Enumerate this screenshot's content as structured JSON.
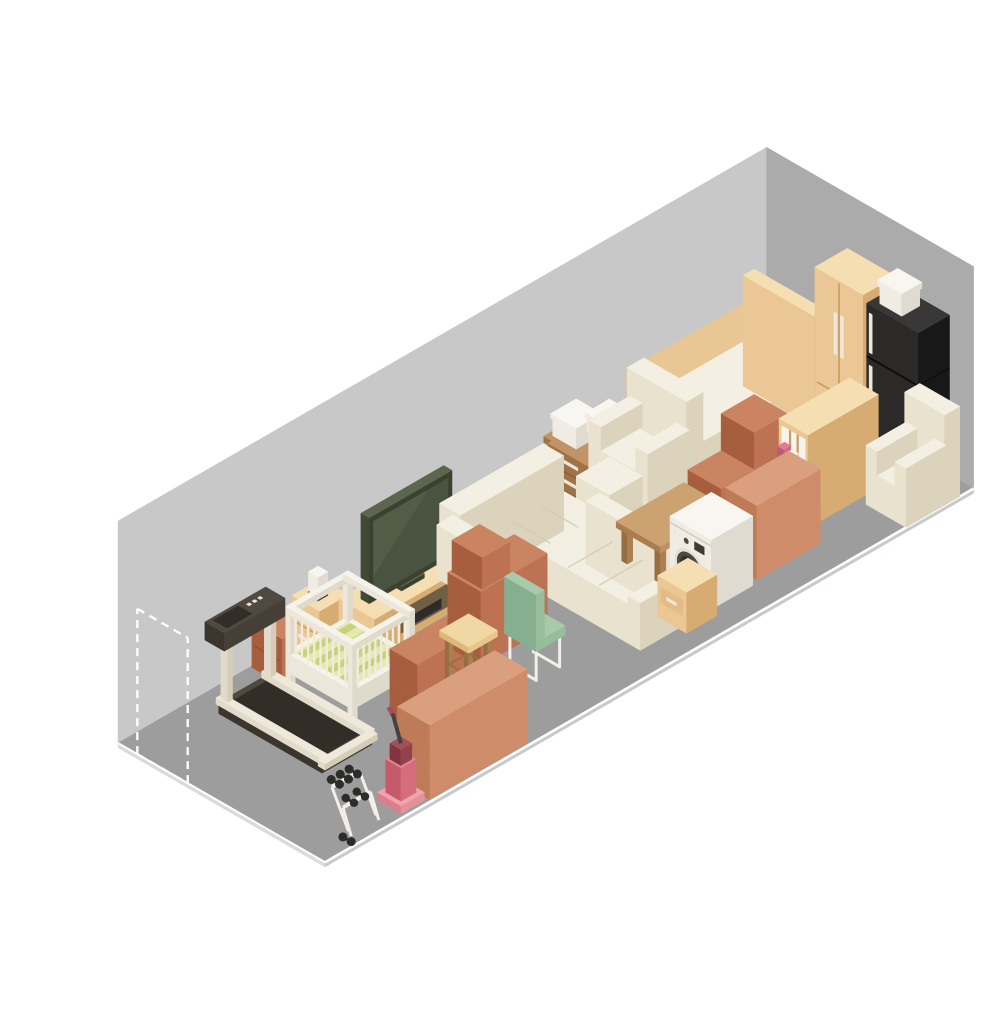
{
  "scene": {
    "description": "Isometric illustration of a long self-storage unit filled with household furniture: treadmill, dumbbell rack, baby crib, dressers, TV with media stand, stacks of terracotta moving boxes, sectional sofa, stool, green chair, coffee table, desk with boxes, office chair, armchairs with ottoman, bed, shelving unit with bins, washing machine, nightstand, wardrobe, refrigerator and an upright vacuum, with a dashed door outline at the open end",
    "canvas": {
      "width": 1000,
      "height": 1000,
      "background": "#ffffff"
    },
    "palette": {
      "wallBack": "#c8c8c8",
      "wallRight": "#ababab",
      "floor": "#9d9d9d",
      "slabFront": "#c7cacb",
      "slabLeft": "#d9dbdc",
      "edgeLine": "#ffffff",
      "boxA": {
        "top": "#cb8462",
        "left": "#a65e3f",
        "right": "#bd7253"
      },
      "boxB": {
        "top": "#d99f7e",
        "left": "#bf7b58",
        "right": "#cf8c6a"
      },
      "boxSeam": "#8f4f33",
      "cream": {
        "top": "#f3efe2",
        "left": "#e9e2cf",
        "right": "#dcd3bd"
      },
      "seam": "#d6ccb2",
      "tan": {
        "top": "#f4deb2",
        "left": "#eac795",
        "right": "#d6ac73"
      },
      "tanLine": "#c89b5e",
      "tanDrawer": "#e3bd85",
      "tanPanel": "#e9c795",
      "bedBase": {
        "top": "#e6c48c",
        "left": "#c89a5e",
        "right": "#d8ae74"
      },
      "deskWood": {
        "top": "#c29367",
        "left": "#9e7347",
        "right": "#b18156"
      },
      "deskLine": "#8a6239",
      "tableWood": {
        "top": "#cda271",
        "left": "#aa7d4f",
        "right": "#bd8f61"
      },
      "tableLeg": {
        "top": "#c39a6b",
        "left": "#976d42",
        "right": "#ab7f50"
      },
      "tableLegLine": "#9a6f44",
      "stoolTop": {
        "top": "#f0d7a4",
        "left": "#dcb978",
        "right": "#e6c78b"
      },
      "tvBody": {
        "top": "#5d654f",
        "left": "#414936",
        "right": "#39412f"
      },
      "tvScreen": "#4a5340",
      "tvHi": "#535c47",
      "tread": {
        "top": "#4f4941",
        "left": "#3b352e",
        "right": "#463f38"
      },
      "belt": "#322d27",
      "railCream": {
        "top": "#efe9dc",
        "left": "#e2dbcb",
        "right": "#d6cdb9"
      },
      "cribWhite": {
        "top": "#f6f3ea",
        "left": "#ece7da",
        "right": "#e0dacb"
      },
      "cribSlat": "#f1ece0",
      "bedding1": "#e6e9ad",
      "bedding2": "#c8d17b",
      "white": {
        "top": "#f8f6f1",
        "left": "#f0ece4",
        "right": "#e0dbd1"
      },
      "whiteSeam": "#cfc8bb",
      "fridge": {
        "top": "#3a3837",
        "left": "#2c2a29",
        "right": "#191818"
      },
      "fridgeSeam": "#0f0e0e",
      "handle": "#efe7d8",
      "doorRing": "#e6e1d8",
      "doorMid": "#4c4843",
      "doorIn": "#322f2b",
      "panelDark": "#3e3a36",
      "green": {
        "top": "#a9c9ab",
        "left": "#86ae90",
        "right": "#97bd9d"
      },
      "whiteLeg": "#f2efe8",
      "pinkBox": {
        "top": "#e07d93",
        "left": "#c05a74",
        "right": "#d06a84"
      },
      "tealBin": {
        "top": "#4cc0c6",
        "left": "#2b9aa2",
        "right": "#3aadb3"
      },
      "greenBook": {
        "top": "#a3c978",
        "left": "#7da953",
        "right": "#8fbf63"
      },
      "yellowBook": {
        "top": "#eedc85",
        "left": "#d6bd55",
        "right": "#e3cd6b"
      },
      "shelfInterior": "#f7f4ec",
      "standInterior": "#6f5f45",
      "metal": "#2e2c2a",
      "vacBase": {
        "top": "#f0a3ad",
        "left": "#d97f8b",
        "right": "#e59199"
      },
      "vacBody": {
        "top": "#e08693",
        "left": "#c55a6a",
        "right": "#d46e7c"
      },
      "vacMaroon": {
        "top": "#a34f59",
        "left": "#83353f",
        "right": "#93424d"
      },
      "vacDark": "#474043"
    },
    "items": [
      {
        "id": "back-wall",
        "label": "Back wall"
      },
      {
        "id": "right-wall",
        "label": "Right end wall"
      },
      {
        "id": "floor",
        "label": "Concrete floor"
      },
      {
        "id": "floor-edge",
        "label": "Floor edge line"
      },
      {
        "id": "door-outline",
        "label": "Dashed door outline at open end"
      },
      {
        "id": "bed",
        "label": "Bed with tan headboard"
      },
      {
        "id": "wardrobe",
        "label": "Tan wardrobe cabinet"
      },
      {
        "id": "refrigerator",
        "label": "Black refrigerator"
      },
      {
        "id": "box-on-refrigerator",
        "label": "White storage box on refrigerator"
      },
      {
        "id": "desk",
        "label": "Wooden office desk"
      },
      {
        "id": "boxes-on-desk",
        "label": "White storage boxes on desk"
      },
      {
        "id": "office-chair",
        "label": "Office swivel chair"
      },
      {
        "id": "armchair",
        "label": "Cream armchair"
      },
      {
        "id": "ottoman",
        "label": "Cream ottoman"
      },
      {
        "id": "box-stack-by-bed",
        "label": "Moving boxes by bed"
      },
      {
        "id": "bookshelf",
        "label": "Shelving unit with bins and books"
      },
      {
        "id": "storage-cabinet",
        "label": "Terracotta cabinet"
      },
      {
        "id": "dresser",
        "label": "Small tan dresser"
      },
      {
        "id": "vase",
        "label": "Vase on dresser"
      },
      {
        "id": "tv-stand",
        "label": "TV media stand"
      },
      {
        "id": "tv",
        "label": "Flat-screen TV"
      },
      {
        "id": "crib",
        "label": "White baby crib"
      },
      {
        "id": "treadmill",
        "label": "Treadmill"
      },
      {
        "id": "box-stack-by-crib",
        "label": "Moving boxes by crib"
      },
      {
        "id": "sofa",
        "label": "Cream sectional sofa"
      },
      {
        "id": "box-stack-by-tv",
        "label": "Moving boxes by TV"
      },
      {
        "id": "stool",
        "label": "Wooden stool"
      },
      {
        "id": "side-chair",
        "label": "Green side chair"
      },
      {
        "id": "coffee-table",
        "label": "Wooden coffee table"
      },
      {
        "id": "box-stack-by-washer",
        "label": "Moving boxes by washing machine"
      },
      {
        "id": "washing-machine",
        "label": "Washing machine"
      },
      {
        "id": "nightstand",
        "label": "Tan nightstand"
      },
      {
        "id": "armchair-2",
        "label": "Cream armchair by refrigerator"
      },
      {
        "id": "box-stack-front",
        "label": "Moving boxes front row"
      },
      {
        "id": "vacuum",
        "label": "Upright vacuum cleaner"
      },
      {
        "id": "dumbbell-rack",
        "label": "Dumbbell rack with weights"
      }
    ]
  }
}
